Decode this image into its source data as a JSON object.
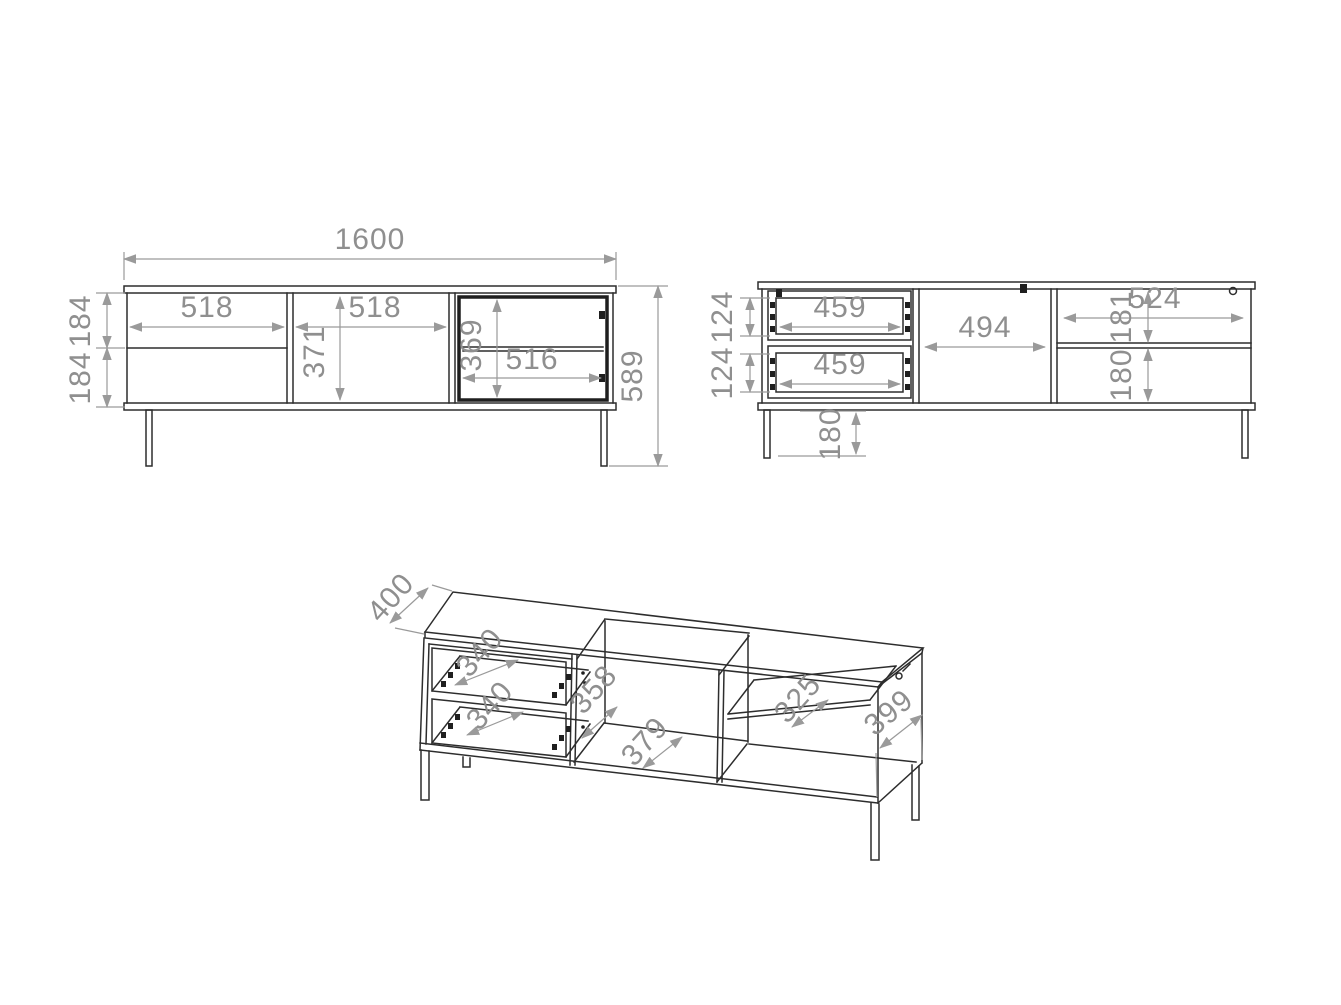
{
  "sheet": {
    "background": "#ffffff"
  },
  "colors": {
    "line": "#2d2d2d",
    "dimension": "#9a9a9a",
    "dimension_text": "#8f8f8f"
  },
  "views": {
    "front_closed": {
      "label": "front-elevation-closed",
      "dims": {
        "overall_width": "1600",
        "overall_height": "589",
        "left_section_width": "518",
        "middle_section_width": "518",
        "middle_section_height": "371",
        "glass_door_height": "369",
        "glass_door_width": "516",
        "upper_drawer_height": "184",
        "lower_drawer_height": "184"
      }
    },
    "front_open": {
      "label": "front-elevation-open",
      "dims": {
        "upper_drawer_width": "459",
        "lower_drawer_width": "459",
        "upper_drawer_height": "124",
        "lower_drawer_height": "124",
        "middle_section_width": "494",
        "right_section_width": "524",
        "right_upper_height": "181",
        "right_lower_height": "180",
        "leg_height": "180"
      }
    },
    "isometric": {
      "label": "isometric-view",
      "dims": {
        "top_depth": "400",
        "upper_drawer_depth": "340",
        "lower_drawer_depth": "340",
        "middle_inner_height": "358",
        "middle_inner_width": "379",
        "shelf_depth": "325",
        "side_depth": "399"
      }
    }
  }
}
